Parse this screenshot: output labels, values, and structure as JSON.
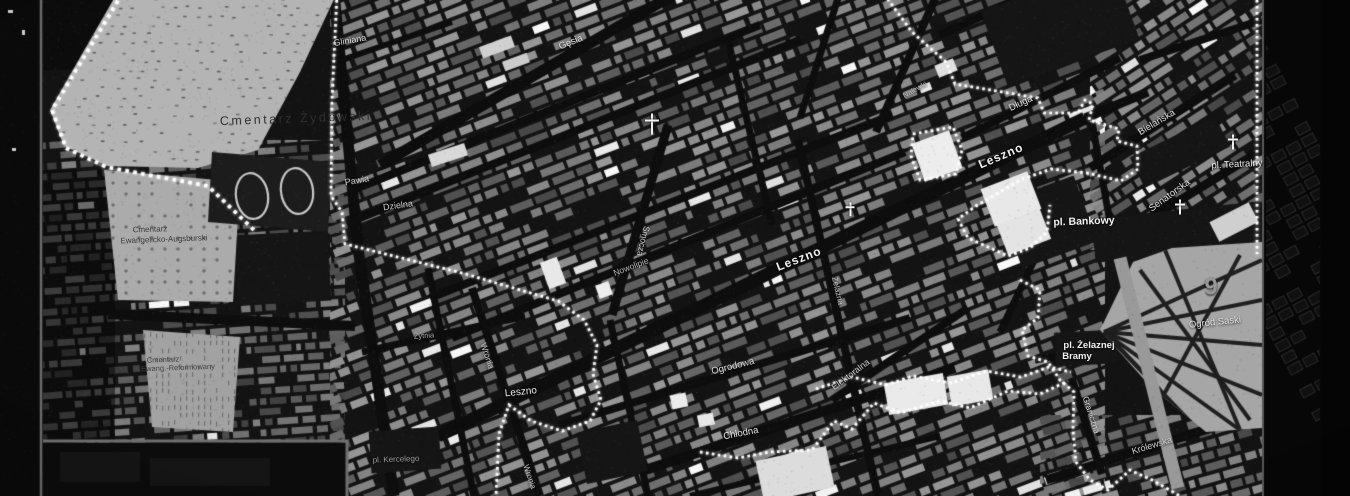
{
  "palette": {
    "map_bg": "#131313",
    "street": "#0d0d0d",
    "boundary": "#ffffff",
    "frame_line": "#6a6a6a",
    "cemetery_fill": "#b4b4b4",
    "park_fill": "#a6a6a6",
    "dark_block": "#1c1c1c"
  },
  "labels": [
    {
      "name": "cemetery-label-zydowski",
      "text": "Cmentarz Żydowski",
      "x": 296,
      "y": 119,
      "rot": -2,
      "size": 12.5,
      "color": "#303030",
      "ls": 2.5
    },
    {
      "name": "cemetery-label-ewang-augsburski-line1",
      "text": "Cmentarz",
      "x": 150,
      "y": 230,
      "rot": -2,
      "size": 8,
      "color": "#3a3a3a"
    },
    {
      "name": "cemetery-label-ewang-augsburski-line2",
      "text": "Ewangelicko-Augsburski",
      "x": 164,
      "y": 240,
      "rot": -2,
      "size": 8,
      "color": "#3a3a3a"
    },
    {
      "name": "cemetery-label-ewang-reform-line1",
      "text": "Cmentarz",
      "x": 163,
      "y": 360,
      "rot": -2,
      "size": 7.5,
      "color": "#404040"
    },
    {
      "name": "cemetery-label-ewang-reform-line2",
      "text": "Ewang.-Reformowany",
      "x": 178,
      "y": 368,
      "rot": -2,
      "size": 7.5,
      "color": "#404040"
    },
    {
      "name": "street-label-gliniana",
      "text": "Gliniana",
      "x": 350,
      "y": 41,
      "rot": -10,
      "size": 9,
      "color": "#d8d8d8"
    },
    {
      "name": "street-label-gesia",
      "text": "Gęsia",
      "x": 571,
      "y": 43,
      "rot": -22,
      "size": 9.5,
      "color": "#e0e0e0"
    },
    {
      "name": "street-label-pawia",
      "text": "Pawia",
      "x": 357,
      "y": 181,
      "rot": -10,
      "size": 9,
      "color": "#cfcfcf"
    },
    {
      "name": "street-label-dzielna",
      "text": "Dzielna",
      "x": 398,
      "y": 206,
      "rot": -8,
      "size": 9,
      "color": "#c8c8c8"
    },
    {
      "name": "street-label-smocza",
      "text": "Smocza",
      "x": 643,
      "y": 241,
      "rot": 104,
      "size": 8.5,
      "color": "#cfcfcf"
    },
    {
      "name": "street-label-nowolipie",
      "text": "Nowolipie",
      "x": 631,
      "y": 267,
      "rot": -21,
      "size": 8.5,
      "color": "#b8b8b8"
    },
    {
      "name": "street-label-leszno-center",
      "text": "Leszno",
      "x": 799,
      "y": 259,
      "rot": -21,
      "size": 12,
      "color": "#f0f0f0",
      "w": 700,
      "ls": 1
    },
    {
      "name": "street-label-leszno-west",
      "text": "Leszno",
      "x": 521,
      "y": 393,
      "rot": -6,
      "size": 10,
      "color": "#e8e8e8"
    },
    {
      "name": "street-label-zytnia",
      "text": "Żytnia",
      "x": 424,
      "y": 336,
      "rot": -4,
      "size": 7.5,
      "color": "#a8a8a8"
    },
    {
      "name": "street-label-wronia",
      "text": "Wronia",
      "x": 487,
      "y": 356,
      "rot": 72,
      "size": 8.5,
      "color": "#c0c0c0"
    },
    {
      "name": "place-label-pl-kercelego",
      "text": "pl. Kercelego",
      "x": 396,
      "y": 460,
      "rot": -2,
      "size": 8,
      "color": "#9a9a9a"
    },
    {
      "name": "street-label-wronia-south",
      "text": "Wronia",
      "x": 529,
      "y": 477,
      "rot": 72,
      "size": 8,
      "color": "#c0c0c0"
    },
    {
      "name": "street-label-ogrodowa",
      "text": "Ogrodowa",
      "x": 733,
      "y": 367,
      "rot": -14,
      "size": 9.5,
      "color": "#dadada"
    },
    {
      "name": "street-label-chlodna",
      "text": "Chłodna",
      "x": 741,
      "y": 434,
      "rot": -11,
      "size": 9.5,
      "color": "#e8e8e8"
    },
    {
      "name": "street-label-elektoralna",
      "text": "Elektoralna",
      "x": 851,
      "y": 375,
      "rot": -37,
      "size": 9,
      "color": "#cfcfcf"
    },
    {
      "name": "street-label-zelazna",
      "text": "Żelazna",
      "x": 837,
      "y": 291,
      "rot": 77,
      "size": 8,
      "color": "#c0c0c0"
    },
    {
      "name": "street-label-nalewki",
      "text": "Nalewki",
      "x": 915,
      "y": 90,
      "rot": -30,
      "size": 7.5,
      "color": "#b8b8b8"
    },
    {
      "name": "street-label-dluga",
      "text": "Długa",
      "x": 1021,
      "y": 104,
      "rot": -25,
      "size": 9.5,
      "color": "#e0e0e0"
    },
    {
      "name": "street-label-bielanska",
      "text": "Bielańska",
      "x": 1157,
      "y": 123,
      "rot": -31,
      "size": 9.5,
      "color": "#e0e0e0"
    },
    {
      "name": "street-label-leszno-east",
      "text": "Leszno",
      "x": 1001,
      "y": 156,
      "rot": -23,
      "size": 12,
      "color": "#f0f0f0",
      "w": 700,
      "ls": 1
    },
    {
      "name": "place-label-pl-teatralny",
      "text": "pl. Teatralny",
      "x": 1237,
      "y": 165,
      "rot": -3,
      "size": 9.5,
      "color": "#ececec"
    },
    {
      "name": "street-label-senatorska",
      "text": "Senatorska",
      "x": 1170,
      "y": 196,
      "rot": -36,
      "size": 9.5,
      "color": "#e0e0e0"
    },
    {
      "name": "place-label-pl-bankowy",
      "text": "pl. Bankowy",
      "x": 1084,
      "y": 222,
      "rot": -2,
      "size": 10.5,
      "color": "#f2f2f2",
      "w": 700
    },
    {
      "name": "place-label-pl-zelaznej-line1",
      "text": "pl. Żelaznej",
      "x": 1089,
      "y": 346,
      "rot": 0,
      "size": 9.5,
      "color": "#f0f0f0",
      "w": 700
    },
    {
      "name": "place-label-pl-zelaznej-line2",
      "text": "Bramy",
      "x": 1077,
      "y": 357,
      "rot": 0,
      "size": 9.5,
      "color": "#f0f0f0",
      "w": 700
    },
    {
      "name": "park-label-ogrod-saski",
      "text": "Ogród Saski",
      "x": 1215,
      "y": 323,
      "rot": -6,
      "size": 9.5,
      "color": "#e2e2e2"
    },
    {
      "name": "street-label-graniczna",
      "text": "Graniczna",
      "x": 1091,
      "y": 415,
      "rot": 72,
      "size": 8.5,
      "color": "#d5d5d5"
    },
    {
      "name": "street-label-krolewska",
      "text": "Królewska",
      "x": 1152,
      "y": 446,
      "rot": -17,
      "size": 9,
      "color": "#cfcfcf"
    },
    {
      "name": "district-number-9",
      "text": "9",
      "x": 1211,
      "y": 287,
      "rot": 0,
      "size": 24,
      "color": "#969696",
      "w": 700
    }
  ],
  "icons": [
    {
      "name": "church-cross-icon",
      "glyph": "✝",
      "x": 1233,
      "y": 142,
      "size": 10
    },
    {
      "name": "church-cross-icon",
      "glyph": "✝",
      "x": 1180,
      "y": 207,
      "size": 10
    },
    {
      "name": "church-cross-icon",
      "glyph": "✝",
      "x": 850,
      "y": 209,
      "size": 9
    },
    {
      "name": "church-cross-icon",
      "glyph": "✝",
      "x": 652,
      "y": 124,
      "size": 14
    }
  ],
  "boundary_polylines": [
    [
      [
        337,
        -6
      ],
      [
        332,
        100
      ],
      [
        331,
        196
      ],
      [
        342,
        212
      ],
      [
        345,
        244
      ],
      [
        462,
        273
      ],
      [
        558,
        301
      ],
      [
        584,
        320
      ],
      [
        597,
        345
      ],
      [
        593,
        374
      ],
      [
        601,
        400
      ],
      [
        590,
        421
      ],
      [
        562,
        431
      ],
      [
        531,
        421
      ],
      [
        509,
        405
      ],
      [
        499,
        434
      ],
      [
        496,
        496
      ]
    ],
    [
      [
        122,
        -6
      ],
      [
        52,
        110
      ],
      [
        66,
        148
      ],
      [
        106,
        167
      ],
      [
        208,
        186
      ],
      [
        256,
        232
      ]
    ],
    [
      [
        884,
        -6
      ],
      [
        912,
        32
      ],
      [
        946,
        62
      ],
      [
        955,
        84
      ],
      [
        1038,
        98
      ],
      [
        1044,
        113
      ],
      [
        1078,
        113
      ],
      [
        1085,
        100
      ],
      [
        1093,
        104
      ],
      [
        1089,
        120
      ],
      [
        1119,
        129
      ],
      [
        1117,
        141
      ],
      [
        1137,
        146
      ],
      [
        1138,
        169
      ],
      [
        1121,
        181
      ],
      [
        1087,
        173
      ],
      [
        1051,
        169
      ],
      [
        1020,
        180
      ],
      [
        1000,
        192
      ],
      [
        976,
        206
      ],
      [
        958,
        219
      ],
      [
        968,
        238
      ],
      [
        1008,
        256
      ],
      [
        1030,
        248
      ],
      [
        1047,
        232
      ],
      [
        1050,
        205
      ]
    ],
    [
      [
        913,
        134
      ],
      [
        953,
        127
      ],
      [
        962,
        150
      ],
      [
        956,
        174
      ],
      [
        920,
        180
      ],
      [
        911,
        156
      ],
      [
        913,
        134
      ]
    ],
    [
      [
        1020,
        280
      ],
      [
        1040,
        290
      ],
      [
        1038,
        318
      ],
      [
        1022,
        330
      ],
      [
        1028,
        356
      ],
      [
        1048,
        362
      ],
      [
        1060,
        380
      ],
      [
        1074,
        392
      ],
      [
        1073,
        430
      ],
      [
        1076,
        462
      ],
      [
        1090,
        480
      ],
      [
        1108,
        490
      ],
      [
        1130,
        470
      ],
      [
        1152,
        480
      ],
      [
        1180,
        496
      ]
    ],
    [
      [
        700,
        452
      ],
      [
        738,
        458
      ],
      [
        770,
        452
      ],
      [
        812,
        450
      ],
      [
        834,
        421
      ],
      [
        852,
        429
      ],
      [
        874,
        403
      ],
      [
        900,
        413
      ],
      [
        940,
        401
      ],
      [
        970,
        408
      ],
      [
        1008,
        391
      ],
      [
        1040,
        394
      ],
      [
        1068,
        381
      ]
    ],
    [
      [
        816,
        389
      ],
      [
        852,
        377
      ],
      [
        886,
        385
      ],
      [
        913,
        376
      ],
      [
        951,
        383
      ],
      [
        986,
        371
      ],
      [
        1021,
        377
      ],
      [
        1049,
        367
      ],
      [
        1071,
        372
      ]
    ],
    [
      [
        1257,
        -6
      ],
      [
        1257,
        254
      ]
    ]
  ],
  "streets": [
    [
      334,
      -8,
      358,
      248,
      11
    ],
    [
      358,
      248,
      394,
      496,
      11
    ],
    [
      330,
      64,
      452,
      22,
      6
    ],
    [
      380,
      165,
      690,
      -15,
      11
    ],
    [
      348,
      192,
      760,
      25,
      8
    ],
    [
      350,
      222,
      800,
      40,
      8
    ],
    [
      430,
      298,
      892,
      115,
      8
    ],
    [
      452,
      338,
      905,
      152,
      8
    ],
    [
      438,
      436,
      1085,
      118,
      13
    ],
    [
      612,
      315,
      668,
      125,
      9
    ],
    [
      362,
      352,
      525,
      316,
      7
    ],
    [
      472,
      288,
      540,
      496,
      8
    ],
    [
      428,
      268,
      474,
      496,
      7
    ],
    [
      108,
      314,
      355,
      326,
      10
    ],
    [
      560,
      425,
      910,
      318,
      8
    ],
    [
      645,
      470,
      955,
      368,
      10
    ],
    [
      690,
      496,
      940,
      436,
      6
    ],
    [
      832,
      400,
      968,
      308,
      8
    ],
    [
      798,
      140,
      878,
      496,
      8
    ],
    [
      876,
      132,
      938,
      -8,
      8
    ],
    [
      800,
      118,
      840,
      -8,
      7
    ],
    [
      728,
      40,
      772,
      225,
      7
    ],
    [
      962,
      138,
      1120,
      58,
      8
    ],
    [
      1090,
      168,
      1235,
      75,
      9
    ],
    [
      1118,
      238,
      1262,
      150,
      9
    ],
    [
      1085,
      118,
      1148,
      92,
      9
    ],
    [
      1092,
      122,
      1110,
      222,
      7
    ],
    [
      1000,
      332,
      1038,
      252,
      7
    ],
    [
      1046,
      480,
      1262,
      412,
      9
    ],
    [
      1072,
      380,
      1102,
      474,
      8
    ],
    [
      1048,
      368,
      1110,
      345,
      7
    ],
    [
      940,
      35,
      1035,
      -8,
      8
    ],
    [
      1140,
      60,
      1262,
      20,
      8
    ],
    [
      610,
      320,
      648,
      496,
      7
    ],
    [
      1035,
      360,
      1115,
      347,
      7
    ]
  ],
  "zones": [
    {
      "poly": [
        [
          43,
          140
        ],
        [
          345,
          140
        ],
        [
          345,
          496
        ],
        [
          43,
          496
        ]
      ],
      "angle": -4,
      "cw": 13,
      "ch": 8,
      "lo": 60,
      "range": 70
    },
    {
      "poly": [
        [
          330,
          0
        ],
        [
          1105,
          0
        ],
        [
          1105,
          496
        ],
        [
          330,
          496
        ]
      ],
      "angle": -21,
      "cw": 16,
      "ch": 9,
      "lo": 72,
      "range": 82
    },
    {
      "poly": [
        [
          1090,
          0
        ],
        [
          1262,
          0
        ],
        [
          1262,
          250
        ],
        [
          1090,
          250
        ]
      ],
      "angle": -33,
      "cw": 14,
      "ch": 9,
      "lo": 70,
      "range": 80
    },
    {
      "poly": [
        [
          1040,
          415
        ],
        [
          1262,
          415
        ],
        [
          1262,
          496
        ],
        [
          1040,
          496
        ]
      ],
      "angle": -16,
      "cw": 14,
      "ch": 9,
      "lo": 70,
      "range": 78
    }
  ],
  "dim_rects": [
    [
      43,
      170,
      72,
      270
    ],
    [
      43,
      0,
      70,
      70
    ],
    [
      43,
      440,
      300,
      56
    ]
  ],
  "black_patches": [
    [
      1048,
      222,
      80,
      70,
      -20
    ],
    [
      1180,
      152,
      95,
      34,
      -26
    ],
    [
      1060,
      25,
      140,
      80,
      -20
    ],
    [
      1086,
      348,
      62,
      34,
      -3
    ],
    [
      1178,
      232,
      170,
      44,
      -6
    ],
    [
      405,
      450,
      70,
      42,
      -4
    ],
    [
      282,
      268,
      95,
      70,
      -3
    ],
    [
      612,
      452,
      62,
      52,
      -12
    ]
  ],
  "cemeteries": {
    "jewish": {
      "poly": [
        [
          116,
          -5
        ],
        [
          336,
          -5
        ],
        [
          300,
          72
        ],
        [
          258,
          150
        ],
        [
          198,
          168
        ],
        [
          108,
          166
        ],
        [
          64,
          146
        ],
        [
          50,
          110
        ]
      ],
      "fill": "#b4b4b4"
    },
    "evangelical": {
      "poly": [
        [
          104,
          170
        ],
        [
          240,
          182
        ],
        [
          233,
          302
        ],
        [
          118,
          300
        ]
      ],
      "fill": "#ababab"
    },
    "reformed": {
      "poly": [
        [
          143,
          330
        ],
        [
          240,
          337
        ],
        [
          233,
          432
        ],
        [
          152,
          427
        ]
      ],
      "fill": "#a2a2a2"
    }
  },
  "sports_field": {
    "poly": [
      [
        212,
        152
      ],
      [
        332,
        162
      ],
      [
        328,
        232
      ],
      [
        208,
        222
      ]
    ],
    "fill": "#1c1c1c",
    "rings": [
      [
        252,
        196,
        16,
        23,
        -8
      ],
      [
        297,
        191,
        16,
        23,
        -8
      ]
    ]
  },
  "park": {
    "poly": [
      [
        1100,
        330
      ],
      [
        1133,
        262
      ],
      [
        1172,
        248
      ],
      [
        1262,
        242
      ],
      [
        1262,
        428
      ],
      [
        1206,
        432
      ],
      [
        1150,
        386
      ]
    ],
    "fan_center": [
      1104,
      332
    ],
    "fan_targets": [
      [
        1262,
        260
      ],
      [
        1262,
        300
      ],
      [
        1262,
        345
      ],
      [
        1262,
        395
      ],
      [
        1240,
        430
      ],
      [
        1200,
        432
      ],
      [
        1160,
        390
      ]
    ],
    "cross_paths": [
      [
        1140,
        270,
        1250,
        420
      ],
      [
        1240,
        255,
        1150,
        420
      ],
      [
        1165,
        250,
        1240,
        430
      ]
    ],
    "road": [
      1120,
      258,
      1178,
      488
    ]
  },
  "landmarks": [
    [
      937,
      156,
      40,
      40,
      -20,
      "#ededed"
    ],
    [
      1011,
      199,
      50,
      40,
      -21,
      "#e8e8e8"
    ],
    [
      1024,
      232,
      46,
      32,
      -21,
      "#e4e4e4"
    ],
    [
      916,
      394,
      60,
      32,
      -10,
      "#eaeaea"
    ],
    [
      970,
      388,
      42,
      30,
      -10,
      "#e8e8e8"
    ],
    [
      795,
      474,
      72,
      42,
      -12,
      "#dcdcdc"
    ],
    [
      553,
      273,
      18,
      28,
      -20,
      "#e8e8e8"
    ],
    [
      604,
      290,
      14,
      14,
      -20,
      "#ededed"
    ],
    [
      946,
      68,
      20,
      13,
      -22,
      "#e0e0e0"
    ],
    [
      1234,
      222,
      44,
      22,
      -27,
      "#cfcfcf"
    ],
    [
      448,
      155,
      38,
      13,
      -18,
      "#d8d8d8"
    ],
    [
      1268,
      295,
      12,
      26,
      0,
      "#e8e8e8"
    ],
    [
      706,
      420,
      16,
      12,
      -12,
      "#e8e8e8"
    ],
    [
      679,
      401,
      16,
      14,
      -12,
      "#ececec"
    ],
    [
      497,
      47,
      34,
      12,
      -20,
      "#d0d0d0"
    ],
    [
      516,
      62,
      26,
      10,
      -20,
      "#cccccc"
    ]
  ],
  "frame": {
    "left_band_w": 41,
    "left_line_x": 41,
    "right_line_x": 1263,
    "right_dark_from": 1322,
    "inset": {
      "x": 43,
      "y": 441,
      "w": 304,
      "h": 55,
      "border": "#6f6f6f"
    }
  }
}
